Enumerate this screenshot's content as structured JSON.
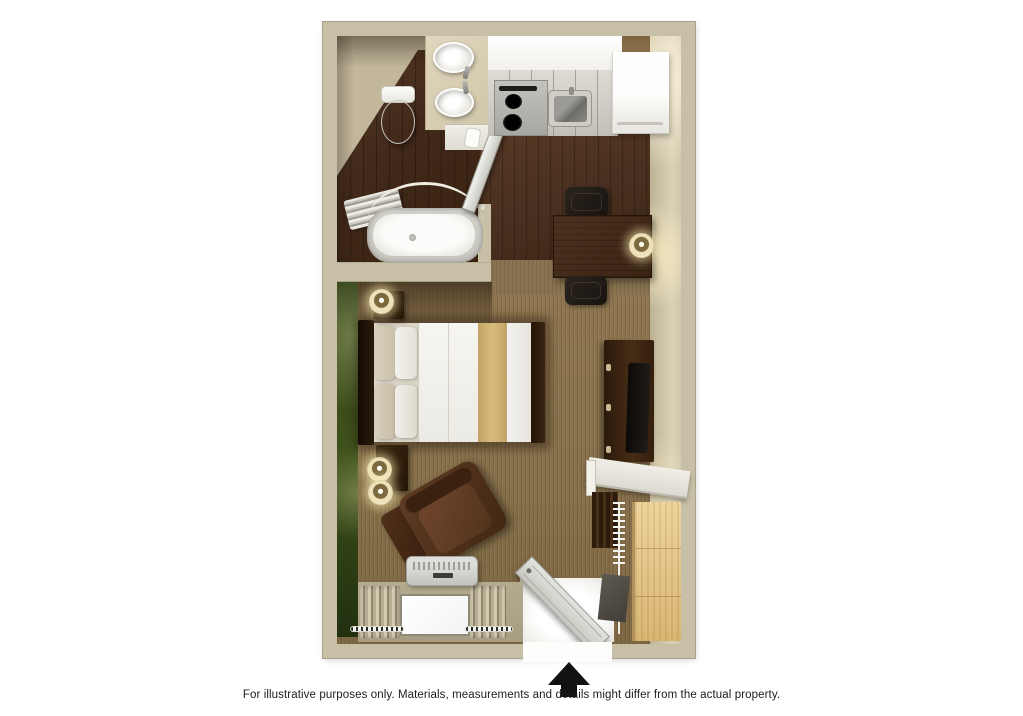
{
  "disclaimer": "For illustrative purposes only.  Materials, measurements and details might differ from the actual property.",
  "entrance_marker": "up-arrow",
  "palette": {
    "wall": "#c7c0a6",
    "accent_wall_green": "#3f511b",
    "carpet": "#8a7049",
    "wood_floor": "#42291a",
    "counter_white": "#f4f3ef",
    "furniture_brown": "#3a2413",
    "closet_wood": "#e2c286",
    "bed_runner": "#d2b474",
    "arrow_black": "#111111"
  },
  "rooms": {
    "bathroom": {
      "fixtures": [
        "toilet",
        "double-sink-vanity",
        "bathtub",
        "shower-rod",
        "towel-bar",
        "bathroom-door"
      ]
    },
    "kitchen": {
      "fixtures": [
        "counter",
        "stove",
        "sink",
        "refrigerator"
      ]
    },
    "living_area": {
      "furniture": [
        "queen-bed",
        "nightstand",
        "table-lamp",
        "desk",
        "desk-chair",
        "desk-lamp",
        "tv-dresser",
        "television",
        "armchair",
        "ottoman",
        "ptac-unit",
        "window",
        "curtains"
      ]
    },
    "entry": {
      "features": [
        "entry-door",
        "closet-shelf",
        "hanging-rod",
        "closet-panel"
      ]
    }
  }
}
